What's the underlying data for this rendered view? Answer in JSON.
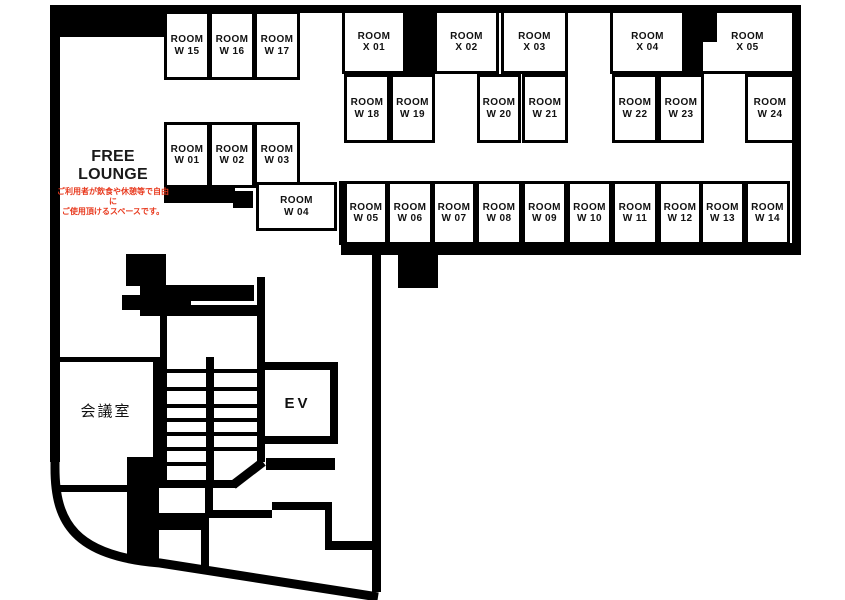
{
  "colors": {
    "wall": "#000000",
    "note_red": "#e8391e",
    "text": "#111111"
  },
  "free_lounge": {
    "title": "FREE LOUNGE",
    "note_line1": "ご利用者が飲食や休憩等で自由に",
    "note_line2": "ご使用頂けるスペースです。"
  },
  "meeting_room": {
    "label": "会議室"
  },
  "elevator": {
    "label": "EV"
  },
  "rooms": [
    {
      "id": "room-w15",
      "line1": "ROOM",
      "line2": "W 15",
      "x": 164,
      "y": 11,
      "w": 46,
      "h": 69
    },
    {
      "id": "room-w16",
      "line1": "ROOM",
      "line2": "W 16",
      "x": 209,
      "y": 11,
      "w": 46,
      "h": 69
    },
    {
      "id": "room-w17",
      "line1": "ROOM",
      "line2": "W 17",
      "x": 254,
      "y": 11,
      "w": 46,
      "h": 69
    },
    {
      "id": "room-x01",
      "line1": "ROOM",
      "line2": "X 01",
      "x": 342,
      "y": 10,
      "w": 64,
      "h": 64
    },
    {
      "id": "room-x02",
      "line1": "ROOM",
      "line2": "X 02",
      "x": 434,
      "y": 10,
      "w": 65,
      "h": 64
    },
    {
      "id": "room-x03",
      "line1": "ROOM",
      "line2": "X 03",
      "x": 501,
      "y": 10,
      "w": 67,
      "h": 64
    },
    {
      "id": "room-x04",
      "line1": "ROOM",
      "line2": "X 04",
      "x": 610,
      "y": 10,
      "w": 75,
      "h": 64
    },
    {
      "id": "room-x05",
      "line1": "ROOM",
      "line2": "X 05",
      "x": 700,
      "y": 10,
      "w": 95,
      "h": 64
    },
    {
      "id": "room-w18",
      "line1": "ROOM",
      "line2": "W 18",
      "x": 344,
      "y": 74,
      "w": 46,
      "h": 69
    },
    {
      "id": "room-w19",
      "line1": "ROOM",
      "line2": "W 19",
      "x": 390,
      "y": 74,
      "w": 45,
      "h": 69
    },
    {
      "id": "room-w20",
      "line1": "ROOM",
      "line2": "W 20",
      "x": 477,
      "y": 74,
      "w": 44,
      "h": 69
    },
    {
      "id": "room-w21",
      "line1": "ROOM",
      "line2": "W 21",
      "x": 522,
      "y": 74,
      "w": 46,
      "h": 69
    },
    {
      "id": "room-w22",
      "line1": "ROOM",
      "line2": "W 22",
      "x": 612,
      "y": 74,
      "w": 46,
      "h": 69
    },
    {
      "id": "room-w23",
      "line1": "ROOM",
      "line2": "W 23",
      "x": 658,
      "y": 74,
      "w": 46,
      "h": 69
    },
    {
      "id": "room-w24",
      "line1": "ROOM",
      "line2": "W 24",
      "x": 745,
      "y": 74,
      "w": 50,
      "h": 69
    },
    {
      "id": "room-w01",
      "line1": "ROOM",
      "line2": "W 01",
      "x": 164,
      "y": 122,
      "w": 46,
      "h": 66
    },
    {
      "id": "room-w02",
      "line1": "ROOM",
      "line2": "W 02",
      "x": 209,
      "y": 122,
      "w": 46,
      "h": 66
    },
    {
      "id": "room-w03",
      "line1": "ROOM",
      "line2": "W 03",
      "x": 254,
      "y": 122,
      "w": 46,
      "h": 66
    },
    {
      "id": "room-w04",
      "line1": "ROOM",
      "line2": "W 04",
      "x": 256,
      "y": 182,
      "w": 81,
      "h": 49
    },
    {
      "id": "room-w05",
      "line1": "ROOM",
      "line2": "W 05",
      "x": 344,
      "y": 181,
      "w": 44,
      "h": 64
    },
    {
      "id": "room-w06",
      "line1": "ROOM",
      "line2": "W 06",
      "x": 387,
      "y": 181,
      "w": 46,
      "h": 64
    },
    {
      "id": "room-w07",
      "line1": "ROOM",
      "line2": "W 07",
      "x": 432,
      "y": 181,
      "w": 44,
      "h": 64
    },
    {
      "id": "room-w08",
      "line1": "ROOM",
      "line2": "W 08",
      "x": 476,
      "y": 181,
      "w": 46,
      "h": 64
    },
    {
      "id": "room-w09",
      "line1": "ROOM",
      "line2": "W 09",
      "x": 522,
      "y": 181,
      "w": 45,
      "h": 64
    },
    {
      "id": "room-w10",
      "line1": "ROOM",
      "line2": "W 10",
      "x": 567,
      "y": 181,
      "w": 45,
      "h": 64
    },
    {
      "id": "room-w11",
      "line1": "ROOM",
      "line2": "W 11",
      "x": 612,
      "y": 181,
      "w": 46,
      "h": 64
    },
    {
      "id": "room-w12",
      "line1": "ROOM",
      "line2": "W 12",
      "x": 658,
      "y": 181,
      "w": 44,
      "h": 64
    },
    {
      "id": "room-w13",
      "line1": "ROOM",
      "line2": "W 13",
      "x": 700,
      "y": 181,
      "w": 45,
      "h": 64
    },
    {
      "id": "room-w14",
      "line1": "ROOM",
      "line2": "W 14",
      "x": 745,
      "y": 181,
      "w": 45,
      "h": 64
    }
  ]
}
